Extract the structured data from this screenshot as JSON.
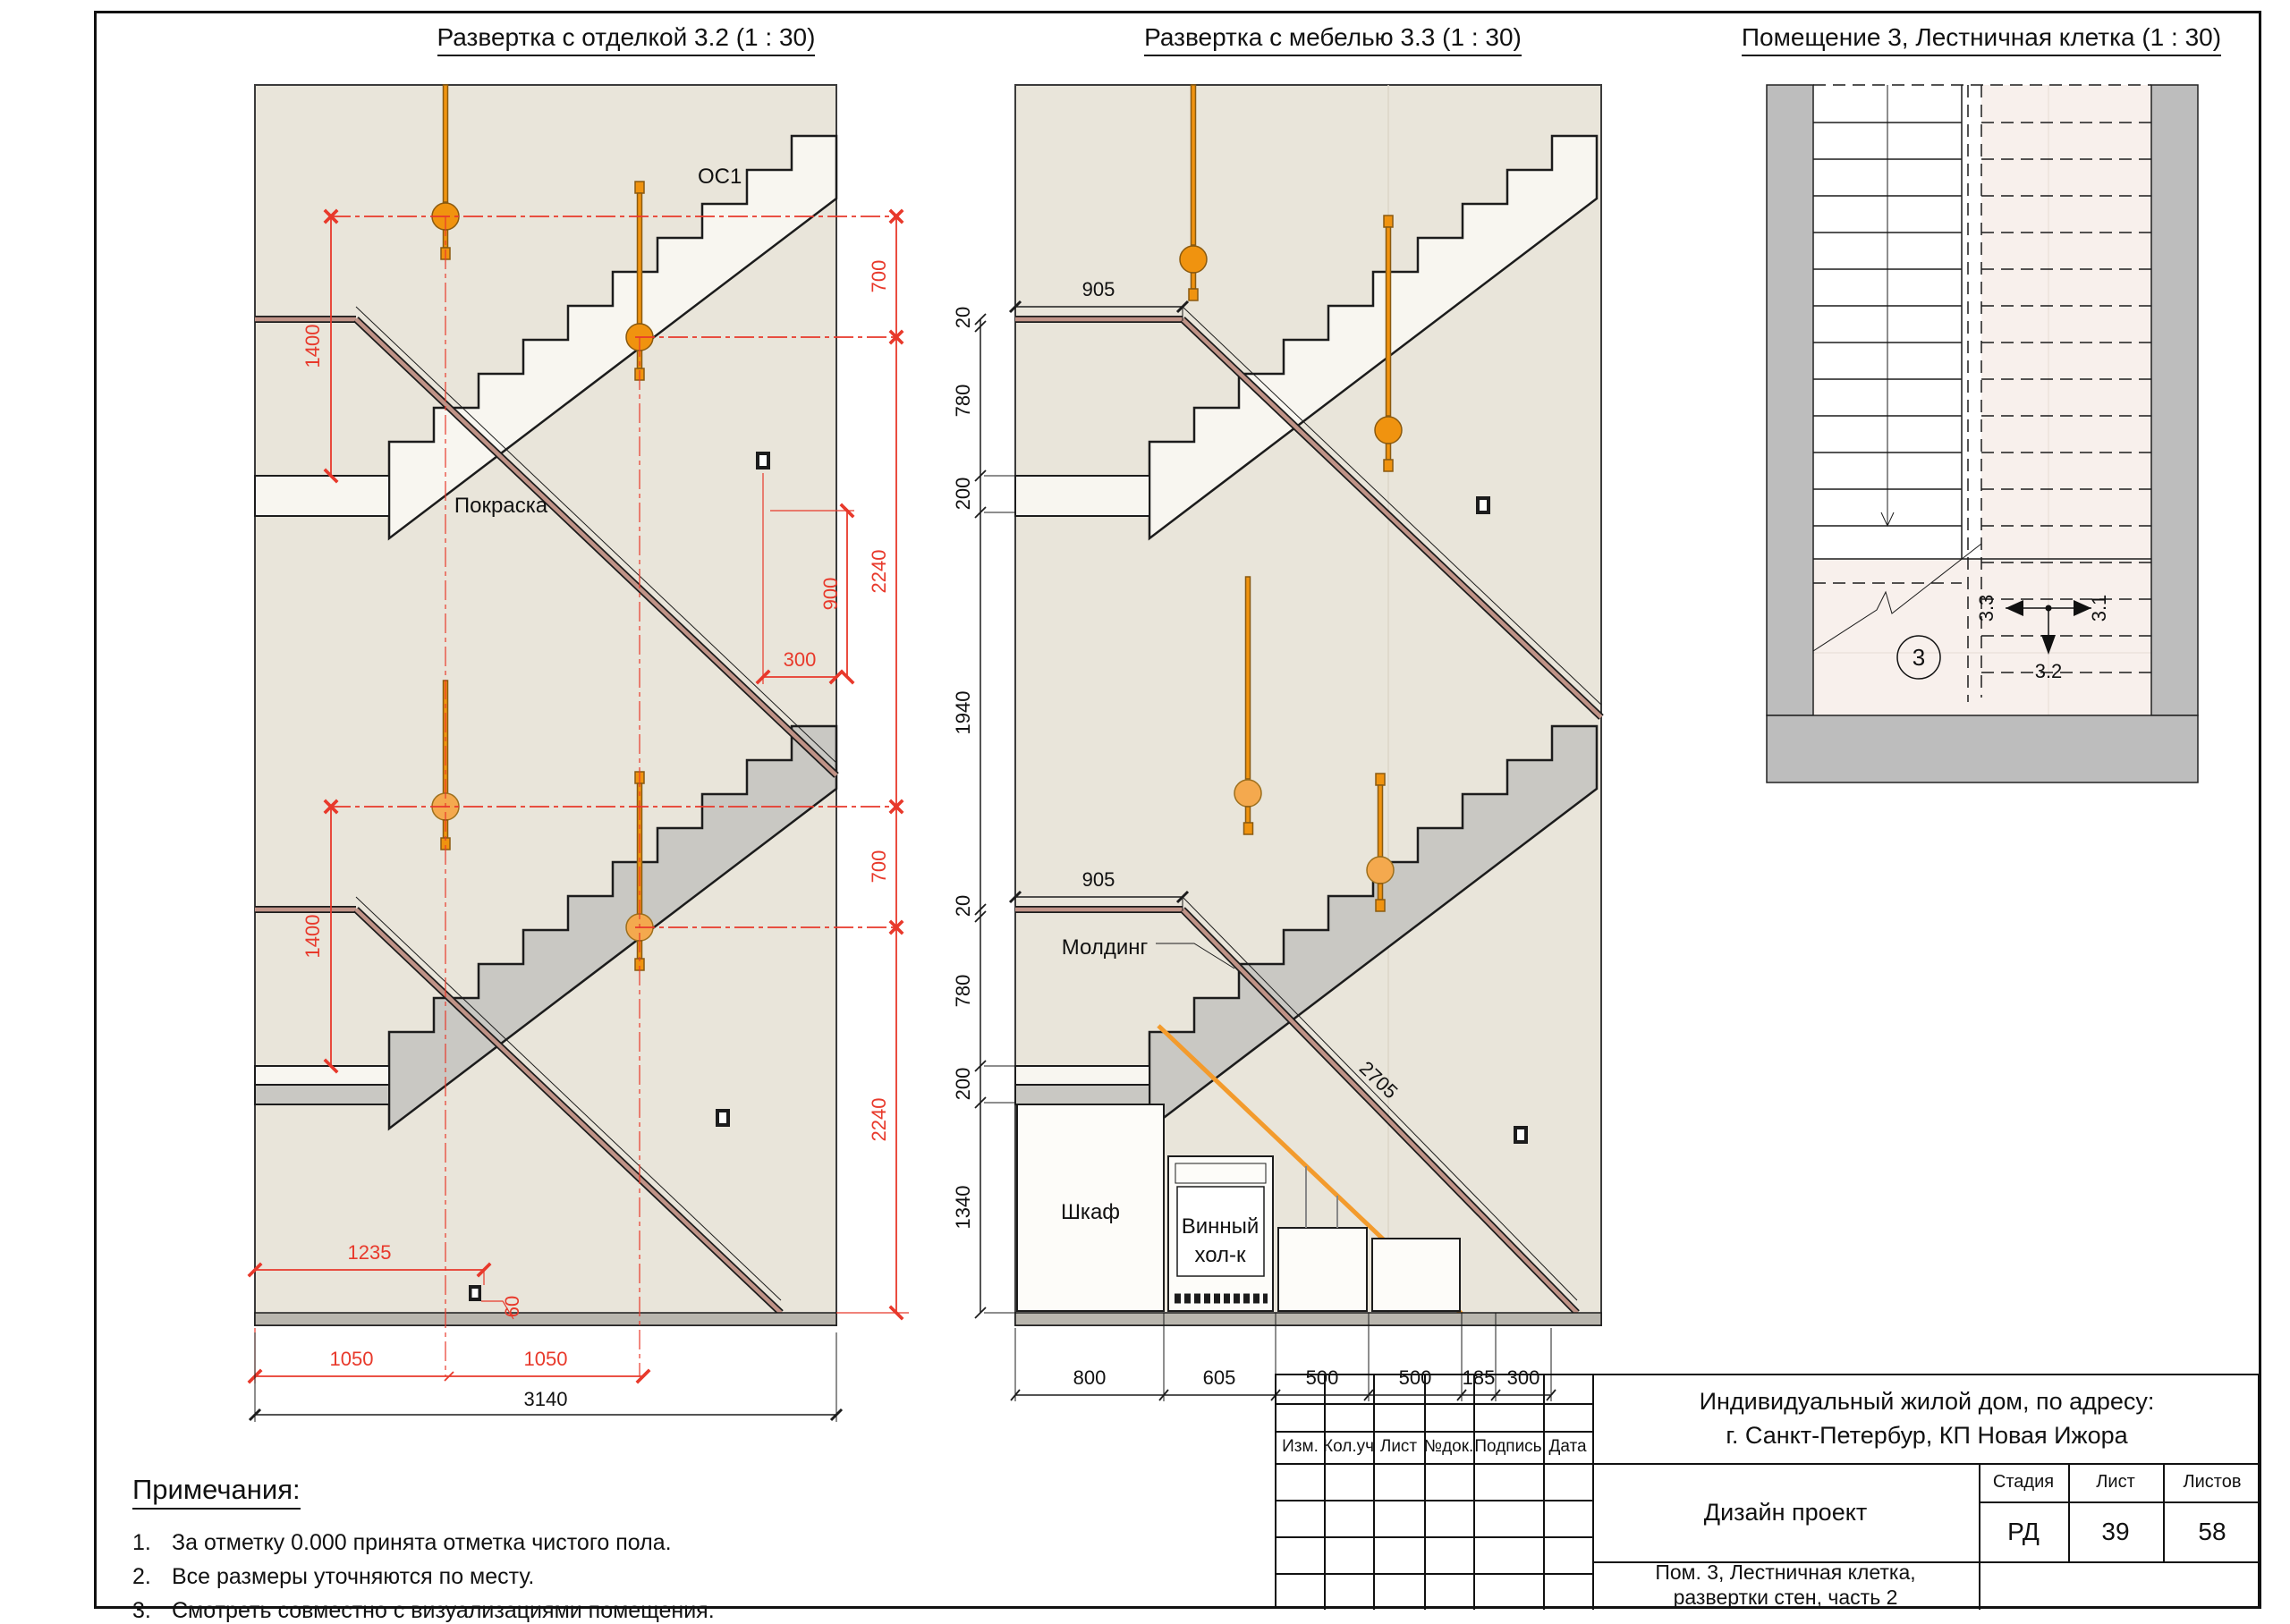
{
  "titles": {
    "view1": "Развертка с отделкой 3.2 (1 : 30)",
    "view2": "Развертка с мебелью 3.3 (1 : 30)",
    "view3": "Помещение 3, Лестничная клетка (1 : 30)"
  },
  "left_view": {
    "label_oc1": "ОС1",
    "label_paint": "Покраска",
    "dim_1400": "1400",
    "dim_700": "700",
    "dim_2240": "2240",
    "dim_900": "900",
    "dim_300": "300",
    "dim_1235": "1235",
    "dim_60": "60",
    "dim_1050": "1050",
    "dim_3140": "3140"
  },
  "middle_view": {
    "label_molding": "Молдинг",
    "label_rail_length": "2705",
    "label_cabinet": "Шкаф",
    "label_wine_line1": "Винный",
    "label_wine_line2": "хол-к",
    "dim_905": "905",
    "dim_20": "20",
    "dim_780": "780",
    "dim_200": "200",
    "dim_1940": "1940",
    "dim_1340": "1340",
    "bottom_dims": [
      "800",
      "605",
      "500",
      "500",
      "185",
      "300"
    ]
  },
  "plan_view": {
    "room_number": "3",
    "ref_left": "3.3",
    "ref_right": "3.1",
    "ref_down": "3.2"
  },
  "notes": {
    "heading": "Примечания:",
    "items": [
      {
        "num": "1.",
        "text": "За отметку 0.000 принята отметка чистого пола."
      },
      {
        "num": "2.",
        "text": "Все размеры уточняются по месту."
      },
      {
        "num": "3.",
        "text": "Смотреть совместно с визуализациями помещения."
      }
    ]
  },
  "title_block": {
    "project_line1": "Индивидуальный жилой дом, по адресу:",
    "project_line2": "г. Санкт-Петербур, КП Новая Ижора",
    "doc_type": "Дизайн проект",
    "sheet_title_line1": "Пом. 3, Лестничная клетка,",
    "sheet_title_line2": "развертки стен, часть 2",
    "col_izm": "Изм.",
    "col_koluch": "Кол.уч",
    "col_list": "Лист",
    "col_ndok": "№док.",
    "col_podpis": "Подпись",
    "col_data": "Дата",
    "stage_label": "Стадия",
    "sheet_label": "Лист",
    "sheets_label": "Листов",
    "stage_value": "РД",
    "sheet_value": "39",
    "sheets_value": "58"
  },
  "colors": {
    "wall_beige": "#e9e5da",
    "stair_white": "#f8f6f0",
    "flight_gray": "#c9c8c3",
    "dim_red": "#e8392b",
    "pendant_orange": "#f0930f",
    "handrail_brown": "#c09387",
    "plan_wall_gray": "#bdbdbd",
    "plan_floor_pink": "#f8f0ec"
  }
}
